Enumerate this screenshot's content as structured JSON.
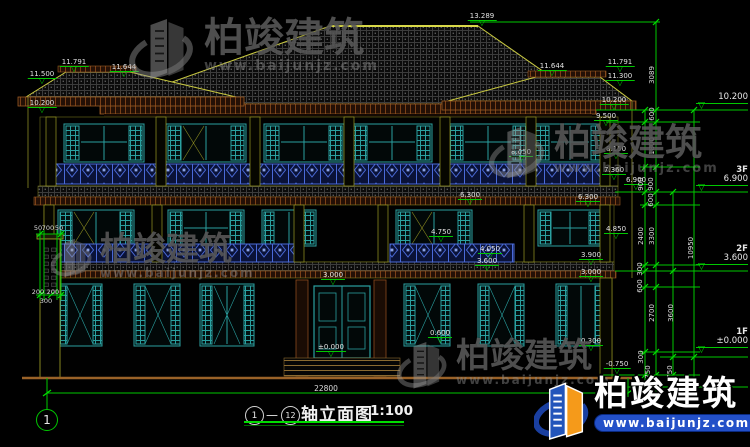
{
  "colors": {
    "background": "#000000",
    "dimension_green": "#00c800",
    "text_white": "#e2e2e2",
    "outline_yellow": "#b8b832",
    "window_teal": "#2aa0a0",
    "railing_blue": "#4a6ad8",
    "fascia_brown": "#7a4018",
    "watermark_gray": "#969696",
    "logo_blue": "#1a3fa0",
    "logo_orange": "#f59a1a",
    "banner_blue": "#2350c8"
  },
  "watermark": {
    "brand": "柏竣建筑",
    "url": "www.baijunjz.com"
  },
  "elev": [
    "13.289",
    "11.791",
    "11.644",
    "11.500",
    "10.200",
    "11.644",
    "11.791",
    "11.300",
    "10.200",
    "9.500",
    "8.050",
    "8.150",
    "7.360",
    "6.900",
    "6.300",
    "6.300",
    "4.750",
    "4.850",
    "4.050",
    "3.900",
    "3.600",
    "3.000",
    "3.000",
    "0.600",
    "0.300",
    "±0.000",
    "-0.750"
  ],
  "right_markers": {
    "top": "10.200",
    "f3_tag": "3F",
    "f3_val": "6.900",
    "f2_tag": "2F",
    "f2_val": "3.600",
    "f1_tag": "1F",
    "f1_val": "±0.000"
  },
  "chains": [
    "3089",
    "600",
    "1800",
    "900",
    "900",
    "600",
    "2400",
    "3300",
    "10950",
    "300",
    "600",
    "2700",
    "3600",
    "300",
    "750",
    "750"
  ],
  "left_dims": [
    "50",
    "700",
    "50",
    "200",
    "200",
    "300"
  ],
  "titlebar": {
    "axis_from": "1",
    "dash": "—",
    "axis_to": "12",
    "title": "轴立面图",
    "scale": "1:100",
    "total": "22800",
    "bubble": "1"
  }
}
